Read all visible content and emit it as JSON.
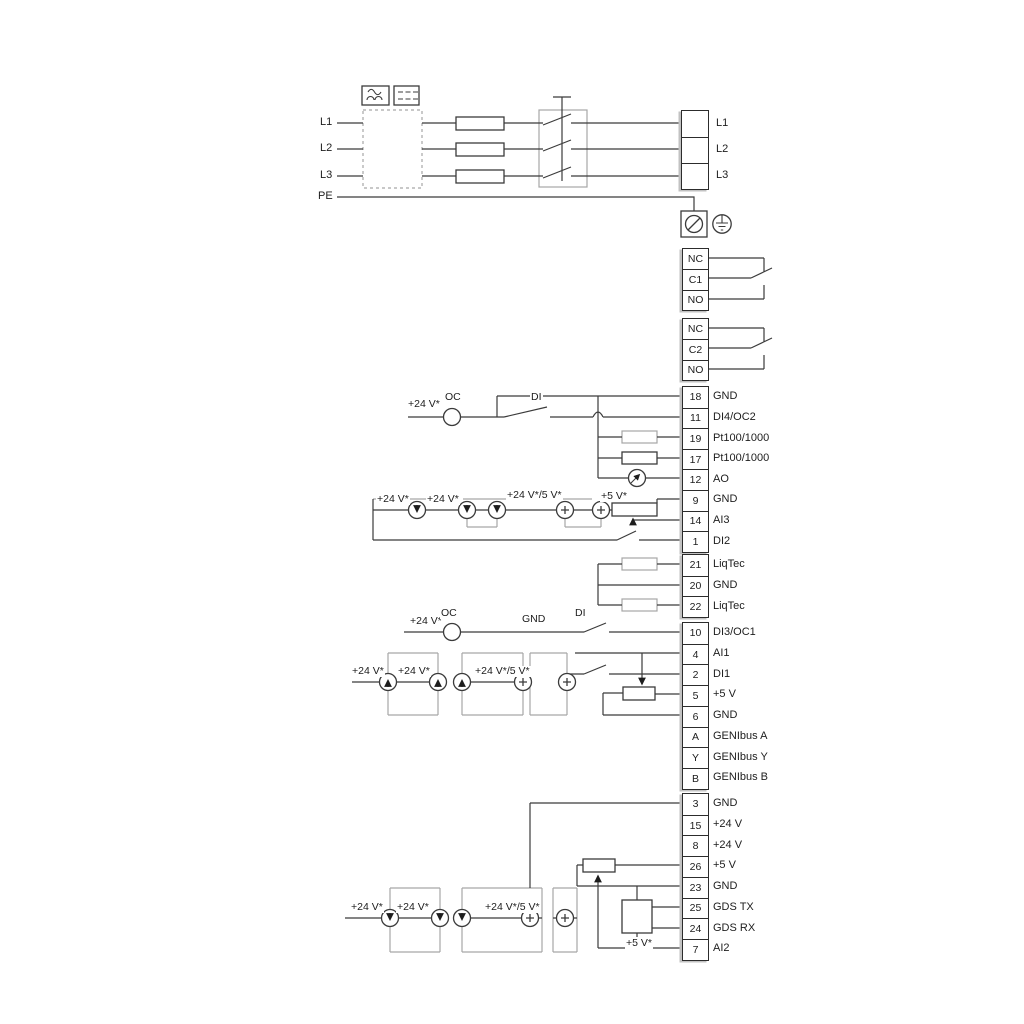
{
  "colors": {
    "wire": "#3b3b3b",
    "gray": "#a6a6a6",
    "text": "#222222",
    "bg": "#ffffff"
  },
  "power_in_labels": [
    {
      "text": "L1"
    },
    {
      "text": "L2"
    },
    {
      "text": "L3"
    },
    {
      "text": "PE"
    }
  ],
  "blocks": [
    {
      "id": "power_out",
      "rows": [
        {
          "cell": "",
          "label": "L1"
        },
        {
          "cell": "",
          "label": "L2"
        },
        {
          "cell": "",
          "label": "L3"
        }
      ]
    },
    {
      "id": "relay1",
      "rows": [
        {
          "cell": "NC",
          "label": ""
        },
        {
          "cell": "C1",
          "label": ""
        },
        {
          "cell": "NO",
          "label": ""
        }
      ]
    },
    {
      "id": "relay2",
      "rows": [
        {
          "cell": "NC",
          "label": ""
        },
        {
          "cell": "C2",
          "label": ""
        },
        {
          "cell": "NO",
          "label": ""
        }
      ]
    },
    {
      "id": "strip_a",
      "rows": [
        {
          "cell": "18",
          "label": "GND"
        },
        {
          "cell": "11",
          "label": "DI4/OC2"
        },
        {
          "cell": "19",
          "label": "Pt100/1000"
        },
        {
          "cell": "17",
          "label": "Pt100/1000"
        },
        {
          "cell": "12",
          "label": "AO"
        },
        {
          "cell": "9",
          "label": "GND"
        },
        {
          "cell": "14",
          "label": "AI3"
        },
        {
          "cell": "1",
          "label": "DI2"
        }
      ]
    },
    {
      "id": "strip_b",
      "rows": [
        {
          "cell": "21",
          "label": "LiqTec"
        },
        {
          "cell": "20",
          "label": "GND"
        },
        {
          "cell": "22",
          "label": "LiqTec"
        }
      ]
    },
    {
      "id": "strip_c",
      "rows": [
        {
          "cell": "10",
          "label": "DI3/OC1"
        },
        {
          "cell": "4",
          "label": "AI1"
        },
        {
          "cell": "2",
          "label": "DI1"
        },
        {
          "cell": "5",
          "label": "+5 V"
        },
        {
          "cell": "6",
          "label": "GND"
        },
        {
          "cell": "A",
          "label": "GENIbus A"
        },
        {
          "cell": "Y",
          "label": "GENIbus Y"
        },
        {
          "cell": "B",
          "label": "GENIbus B"
        }
      ]
    },
    {
      "id": "strip_d",
      "rows": [
        {
          "cell": "3",
          "label": "GND"
        },
        {
          "cell": "15",
          "label": "+24 V"
        },
        {
          "cell": "8",
          "label": "+24 V"
        },
        {
          "cell": "26",
          "label": "+5 V"
        },
        {
          "cell": "23",
          "label": "GND"
        },
        {
          "cell": "25",
          "label": "GDS TX"
        },
        {
          "cell": "24",
          "label": "GDS RX"
        },
        {
          "cell": "7",
          "label": "AI2"
        }
      ]
    }
  ],
  "annotations": [
    {
      "text": "+24 V*",
      "x": 407,
      "y": 399
    },
    {
      "text": "OC",
      "x": 444,
      "y": 392
    },
    {
      "text": "DI",
      "x": 530,
      "y": 392
    },
    {
      "text": "+24 V*",
      "x": 376,
      "y": 494
    },
    {
      "text": "+24 V*",
      "x": 426,
      "y": 494
    },
    {
      "text": "+24 V*/5 V*",
      "x": 506,
      "y": 490
    },
    {
      "text": "+5 V*",
      "x": 600,
      "y": 491
    },
    {
      "text": "+24 V*",
      "x": 409,
      "y": 616
    },
    {
      "text": "OC",
      "x": 440,
      "y": 608
    },
    {
      "text": "GND",
      "x": 521,
      "y": 614
    },
    {
      "text": "DI",
      "x": 574,
      "y": 608
    },
    {
      "text": "+24 V*",
      "x": 351,
      "y": 666
    },
    {
      "text": "+24 V*",
      "x": 397,
      "y": 666
    },
    {
      "text": "+24 V*/5 V*",
      "x": 474,
      "y": 666
    },
    {
      "text": "+24 V*",
      "x": 350,
      "y": 902
    },
    {
      "text": "+24 V*",
      "x": 396,
      "y": 902
    },
    {
      "text": "+24 V*/5 V*",
      "x": 484,
      "y": 902
    },
    {
      "text": "+5 V*",
      "x": 625,
      "y": 938
    }
  ]
}
